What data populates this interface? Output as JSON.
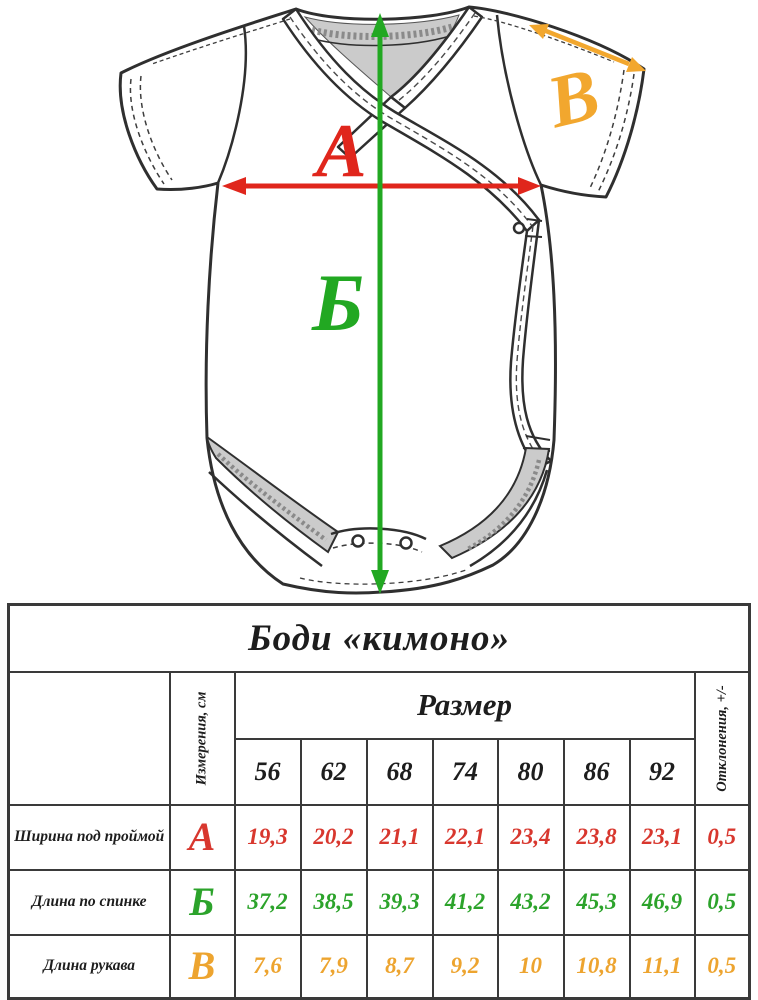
{
  "diagram": {
    "garment": "baby-bodysuit-kimono-front-view",
    "outline_color": "#2f2f2f",
    "lining_color": "#cbcbcb",
    "marker_a": {
      "label": "А",
      "color": "#e0261c"
    },
    "marker_b": {
      "label": "Б",
      "color": "#22a822"
    },
    "marker_v": {
      "label": "В",
      "color": "#f2a72e"
    }
  },
  "table": {
    "title": "Боди «кимоно»",
    "col_measurements": "Измерения, см",
    "col_size": "Размер",
    "col_deviation": "Отклонения, +/-",
    "sizes": [
      "56",
      "62",
      "68",
      "74",
      "80",
      "86",
      "92"
    ],
    "rows": [
      {
        "label": "Ширина под проймой",
        "letter": "А",
        "color": "#d8372e",
        "values": [
          "19,3",
          "20,2",
          "21,1",
          "22,1",
          "23,4",
          "23,8",
          "23,1"
        ],
        "deviation": "0,5"
      },
      {
        "label": "Длина по спинке",
        "letter": "Б",
        "color": "#2ca32b",
        "values": [
          "37,2",
          "38,5",
          "39,3",
          "41,2",
          "43,2",
          "45,3",
          "46,9"
        ],
        "deviation": "0,5"
      },
      {
        "label": "Длина рукава",
        "letter": "В",
        "color": "#eda42f",
        "values": [
          "7,6",
          "7,9",
          "8,7",
          "9,2",
          "10",
          "10,8",
          "11,1"
        ],
        "deviation": "0,5"
      }
    ]
  }
}
